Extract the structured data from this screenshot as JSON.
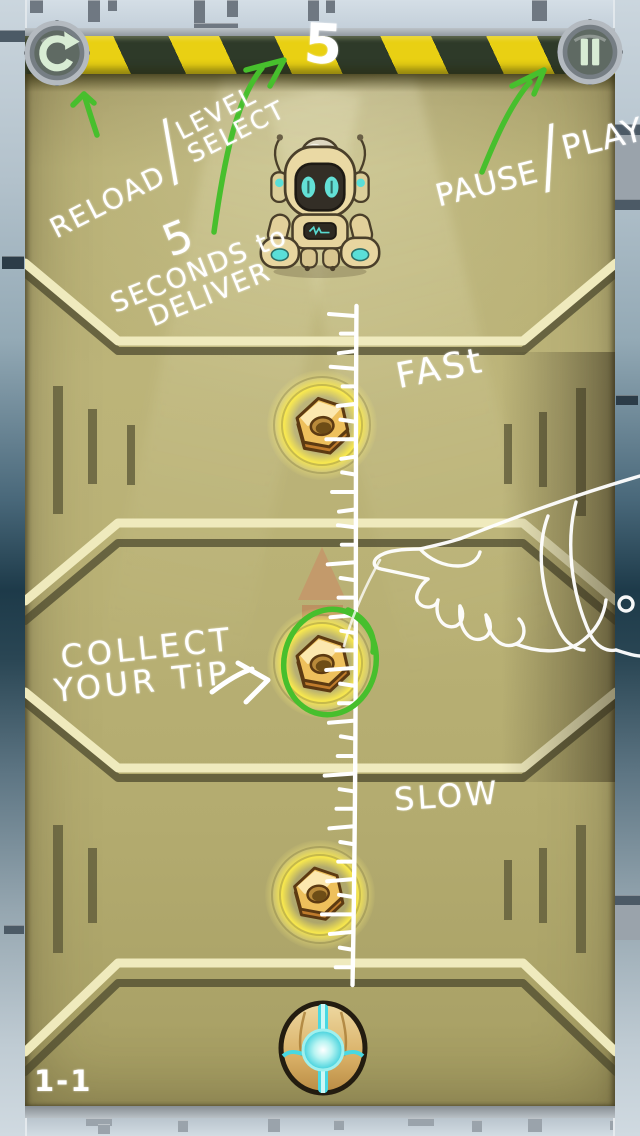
{
  "colors": {
    "hazard-yellow": "#e9d013",
    "hazard-dark": "#2e3a29",
    "board-olive": "#b3ab6f",
    "shelf-cream": "#efeabd",
    "shelf-shadow": "#46432a",
    "annotation-green": "#47bf2d",
    "sketch-white": "#ffffff",
    "glow-yellow": "#ffee4a",
    "accent-teal": "#5adfd8",
    "nut-gold": "#eec05c",
    "button-glyph": "#d8ecd4",
    "wall-light": "#c8d3dc",
    "wall-dark": "#1d3a49"
  },
  "hud": {
    "timer": "5",
    "level": "1-1",
    "reload_button": {
      "icon": "reload-icon"
    },
    "pause_button": {
      "icon": "pause-icon"
    }
  },
  "tutorial": {
    "reload_note": {
      "word1": "RELOAD",
      "slash": "/",
      "word2": "LEVEL",
      "word3": "SELECT"
    },
    "pause_note": {
      "word1": "PAUSE",
      "slash": "/",
      "word2": "PLAY"
    },
    "deliver_note": {
      "line1": "5",
      "line2": "SECONDS to",
      "line3": "DELIVER"
    },
    "speed_fast": "FASt",
    "speed_slow": "SLOW",
    "collect_note": {
      "line1": "COLLECT",
      "line2": "YOUR TiP"
    }
  },
  "objects": {
    "robot": "robot-character",
    "nuts": [
      "hex-nut",
      "hex-nut",
      "hex-nut"
    ],
    "orb": "delivery-orb",
    "indicator": "up-arrow-indicator",
    "ruler": "speed-ruler-sketch",
    "hand": "pointing-hand-sketch"
  }
}
